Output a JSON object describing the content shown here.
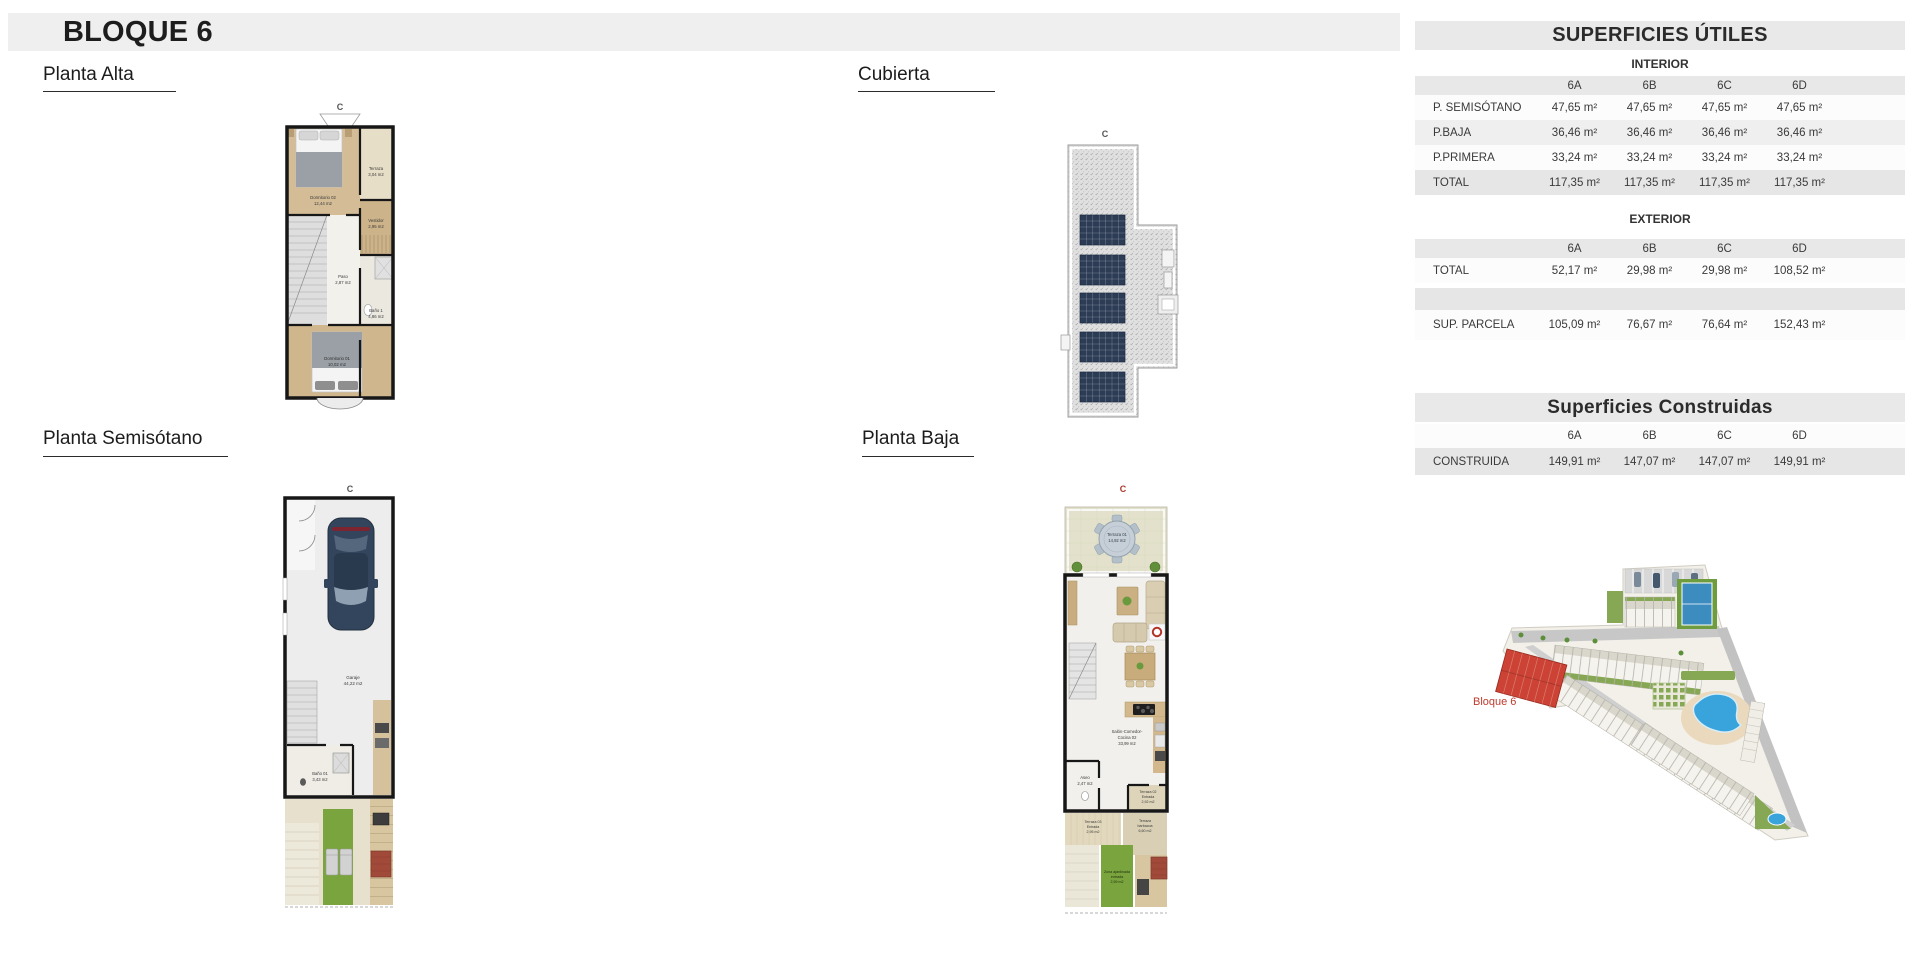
{
  "header": {
    "title": "BLOQUE 6"
  },
  "sections": {
    "planta_alta": "Planta Alta",
    "cubierta": "Cubierta",
    "planta_semisotano": "Planta Semisótano",
    "planta_baja": "Planta Baja"
  },
  "orientation_mark": "C",
  "plans": {
    "alta": {
      "rooms": [
        {
          "lines": [
            "Dormitorio 02",
            "12,44 m2"
          ]
        },
        {
          "lines": [
            "Terraza",
            "3,04 m2"
          ]
        },
        {
          "lines": [
            "Vestidor",
            "2,95 m2"
          ]
        },
        {
          "lines": [
            "Paso",
            "2,87 m2"
          ]
        },
        {
          "lines": [
            "Baño 1",
            "4,86 m2"
          ]
        },
        {
          "lines": [
            "Dormitorio 01",
            "10,02 m2"
          ]
        }
      ]
    },
    "semisotano": {
      "rooms": [
        {
          "lines": [
            "Garaje",
            "44,22 m2"
          ]
        },
        {
          "lines": [
            "Baño 01",
            "3,43 m2"
          ]
        }
      ]
    },
    "baja": {
      "rooms": [
        {
          "lines": [
            "Terraza 01",
            "14,92 m2"
          ]
        },
        {
          "lines": [
            "Salón-Comedor-",
            "Cocina 02",
            "33,99 m2"
          ]
        },
        {
          "lines": [
            "Aseo",
            "2,47 m2"
          ]
        },
        {
          "lines": [
            "Terraza 02",
            "Entrada",
            "2,92 m2"
          ]
        },
        {
          "lines": [
            "Terraza 03",
            "Entrada",
            "2,95 m2"
          ]
        },
        {
          "lines": [
            "Terraza",
            "barbacoa",
            "6,60 m2"
          ]
        },
        {
          "lines": [
            "Zona ajardinada",
            "entrada",
            "2,59 m2"
          ]
        }
      ]
    }
  },
  "tables": {
    "utiles": {
      "title": "SUPERFICIES ÚTILES",
      "interior_label": "INTERIOR",
      "exterior_label": "EXTERIOR",
      "columns": [
        "6A",
        "6B",
        "6C",
        "6D"
      ],
      "interior_rows": [
        {
          "label": "P. SEMISÓTANO",
          "values": [
            "47,65 m²",
            "47,65 m²",
            "47,65 m²",
            "47,65 m²"
          ]
        },
        {
          "label": "P.BAJA",
          "values": [
            "36,46 m²",
            "36,46 m²",
            "36,46 m²",
            "36,46 m²"
          ]
        },
        {
          "label": "P.PRIMERA",
          "values": [
            "33,24 m²",
            "33,24 m²",
            "33,24 m²",
            "33,24 m²"
          ]
        },
        {
          "label": "TOTAL",
          "values": [
            "117,35 m²",
            "117,35 m²",
            "117,35 m²",
            "117,35 m²"
          ]
        }
      ],
      "exterior_rows": [
        {
          "label": "TOTAL",
          "values": [
            "52,17 m²",
            "29,98 m²",
            "29,98 m²",
            "108,52 m²"
          ]
        }
      ],
      "parcela_row": {
        "label": "SUP. PARCELA",
        "values": [
          "105,09 m²",
          "76,67 m²",
          "76,64 m²",
          "152,43 m²"
        ]
      }
    },
    "construidas": {
      "title": "Superficies Construidas",
      "columns": [
        "6A",
        "6B",
        "6C",
        "6D"
      ],
      "rows": [
        {
          "label": "CONSTRUIDA",
          "values": [
            "149,91 m²",
            "147,07 m²",
            "147,07 m²",
            "149,91 m²"
          ]
        }
      ]
    }
  },
  "site_plan": {
    "bloque_label": "Bloque 6",
    "label_color": "#bf3a2c"
  }
}
